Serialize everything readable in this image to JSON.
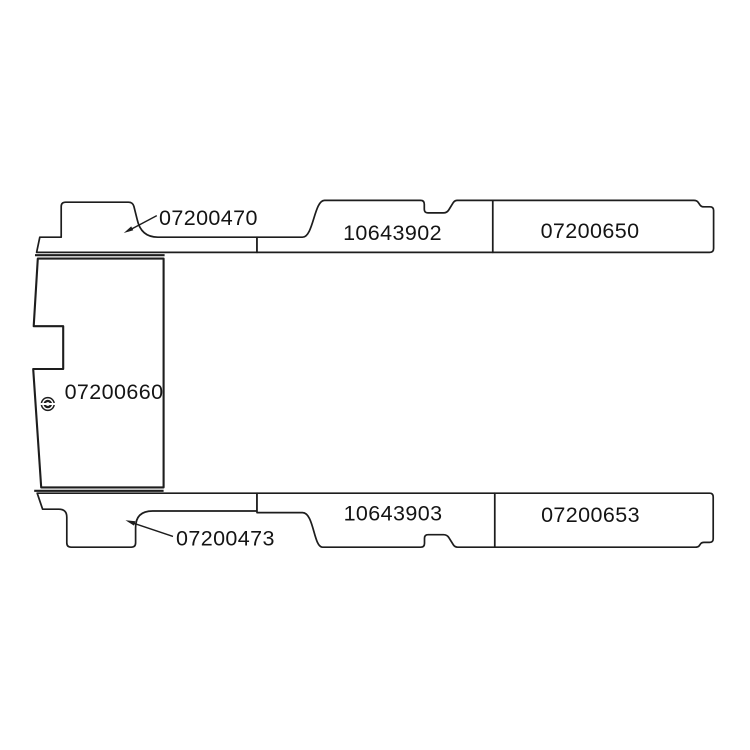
{
  "diagram": {
    "title": "van-floor-panel-part-diagram",
    "background_color": "#ffffff",
    "line_color": "#1d1d1d",
    "panels": {
      "top_left_sill": {
        "label": "07200470"
      },
      "top_middle_sill": {
        "label": "10643902"
      },
      "top_right_sill": {
        "label": "07200650"
      },
      "floor_main": {
        "label": "07200660"
      },
      "bottom_left_sill": {
        "label": "07200473"
      },
      "bottom_middle_sill": {
        "label": "10643903"
      },
      "bottom_right_sill": {
        "label": "07200653"
      }
    }
  }
}
